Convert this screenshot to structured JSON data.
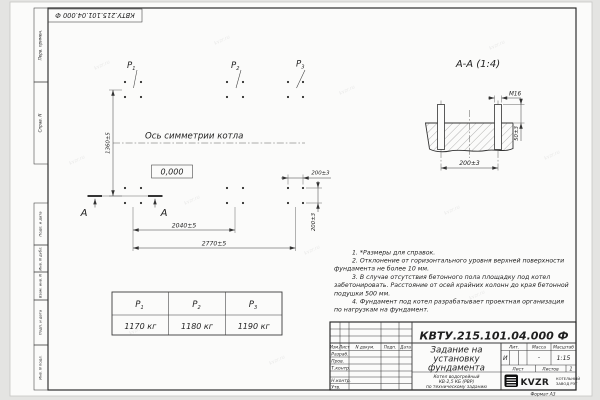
{
  "doc_number": "КВТУ.215.101.04.000 Ф",
  "watermark": "kvzr.ru",
  "frame": {
    "margins": {
      "perv": "Перв. примен.",
      "sprav": "Справ. N",
      "podp1": "Подп. и дата",
      "inv_dubl": "Инв. N дубл.",
      "vzam": "Взам. инв. N",
      "podp2": "Подп. и дата",
      "inv_podl": "Инв. N подл.",
      "format": "Формат А3"
    }
  },
  "plan": {
    "p1": {
      "p": "P",
      "sub": "1"
    },
    "p2": {
      "p": "P",
      "sub": "2"
    },
    "p3": {
      "p": "P",
      "sub": "3"
    },
    "axis_label": "Ось симметрии котла",
    "elevation": "0,000",
    "section_letter_left": "А",
    "section_letter_right": "А",
    "dim_width": "1360±5",
    "dim_len_inner": "2040±5",
    "dim_len_outer": "2770±5",
    "dim_bolt_x": "200±3",
    "dim_bolt_y": "200±3"
  },
  "section": {
    "title": "А-А (1:4)",
    "thread_label": "М16",
    "dim_protrusion": "50±3",
    "dim_spacing": "200±3"
  },
  "notes": [
    "1. *Размеры для справок.",
    "2. Отклонение от горизонтального уровня верхней поверхности",
    "фундамента не более 10 мм.",
    "3. В случае отсутствия бетонного пола площадку под котел",
    "забетонировать. Расстояние от осей крайних колонн до края бетонной",
    "подушки 500 мм.",
    "4. Фундамент под котел разрабатывает проектная организация",
    "по нагрузкам на фундамент."
  ],
  "load_table": {
    "headers": [
      {
        "p": "P",
        "sub": "1"
      },
      {
        "p": "P",
        "sub": "2"
      },
      {
        "p": "P",
        "sub": "3"
      }
    ],
    "values": [
      "1170 кг",
      "1180 кг",
      "1190 кг"
    ]
  },
  "title_block": {
    "cols": {
      "izm": "Изм.",
      "list": "Лист",
      "ndoc": "N докум.",
      "podp": "Подп.",
      "data": "Дата"
    },
    "rows": {
      "razrab": "Разраб.",
      "prov": "Пров.",
      "tkontr": "Т.контр.",
      "nkontr": "Н.контр.",
      "utv": "Утв."
    },
    "title_lines": [
      "Задание на",
      "установку",
      "фундамента"
    ],
    "desc_lines": [
      "Котел водогрейный",
      "КВ-2,5 КБ (РВР)",
      "по техническому заданию"
    ],
    "lit_label": "Лит.",
    "mass_label": "Масса",
    "scale_label": "Масштаб",
    "lit_value": "И",
    "mass_value": "-",
    "scale_value": "1:15",
    "list_label": "Лист",
    "listov_label": "Листов",
    "listov_value": "1",
    "logo_text": "KVZR",
    "logo_sub1": "КОТЕЛЬНЫЙ",
    "logo_sub2": "ЗАВОД РЭТ"
  }
}
